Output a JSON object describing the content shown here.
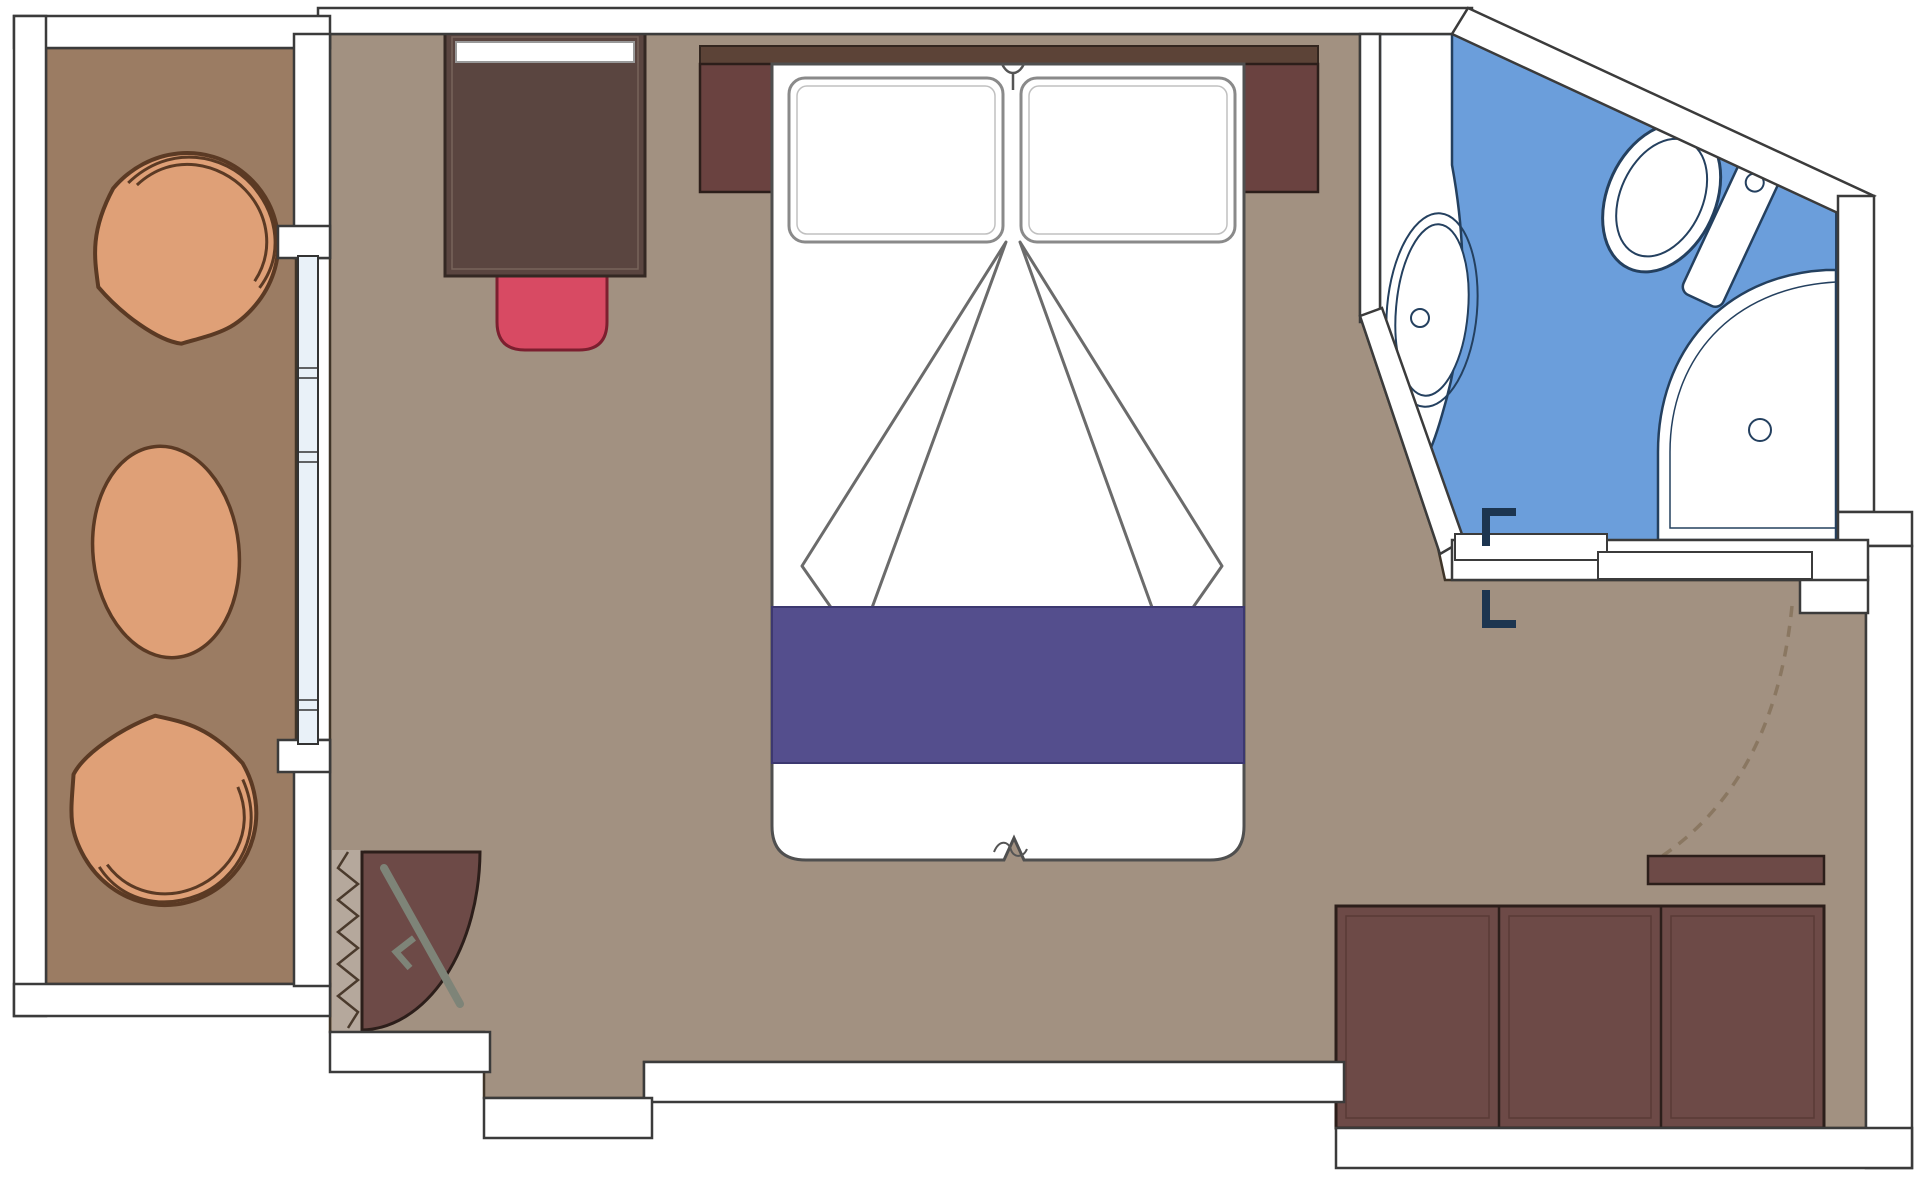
{
  "plan": {
    "type": "cruise-cabin-floor-plan",
    "rooms": [
      {
        "id": "balcony",
        "floor_color_key": "balconyFloor"
      },
      {
        "id": "bedroom",
        "floor_color_key": "roomFloor"
      },
      {
        "id": "bathroom",
        "floor_color_key": "bathFloor"
      }
    ],
    "furniture": [
      "lounge-chair-top",
      "round-side-table",
      "lounge-chair-bottom",
      "sliding-glass-balcony-door",
      "desk-with-shelf",
      "desk-chair",
      "closet-quarter-circle",
      "clothes-rail",
      "curtain-zigzag",
      "headboard",
      "nightstand-left",
      "nightstand-right",
      "double-bed",
      "pillow-left",
      "pillow-right",
      "bed-runner",
      "folded-sheet-left",
      "folded-sheet-right",
      "vanity-counter",
      "sink-basin",
      "toilet",
      "shower-pan",
      "bathroom-sliding-door",
      "door-stop-upper",
      "door-stop-lower",
      "entry-door-swing",
      "entry-shelf",
      "wardrobe-three-door"
    ]
  },
  "colors": {
    "pageBg": "#ffffff",
    "wallFill": "#ffffff",
    "wallStroke": "#3b3b3b",
    "floorStroke": "#3f3428",
    "roomFloor": "#a29181",
    "balconyFloor": "#9b7c63",
    "deskBrown": "#5a4540",
    "deskEdge": "#342823",
    "deskInner": "#78645a",
    "headboard": "#5c4337",
    "headboardEdge": "#33261f",
    "nightstand": "#6a4240",
    "nightstandEdge": "#2c1e1a",
    "wardrobe": "#6d4a47",
    "wardrobeLine": "#2c1e1a",
    "wardrobePanel": "#5a3a37",
    "chairRed": "#d84a63",
    "chairRedStroke": "#7c1f2f",
    "bedWhite": "#ffffff",
    "bedStroke": "#4f4f4f",
    "pillowStroke": "#8a8a8a",
    "pillowInner": "#c0c0c0",
    "sheetLine": "#6b6b6b",
    "stripeBlue": "#544e8d",
    "stripeStroke": "#3c3870",
    "bathFloor": "#6b9edb",
    "bathStroke": "#24405f",
    "fixtureWhite": "#ffffff",
    "orange": "#dfa077",
    "orangeStroke": "#5b3a24",
    "glass": "#e9f1f8",
    "glassStroke": "#333333",
    "dash": "#8a7761",
    "navy": "#1c3550",
    "rail": "#7e8478",
    "curtainBg": "#b5a89c",
    "curtainStroke": "#4a3a2c"
  }
}
